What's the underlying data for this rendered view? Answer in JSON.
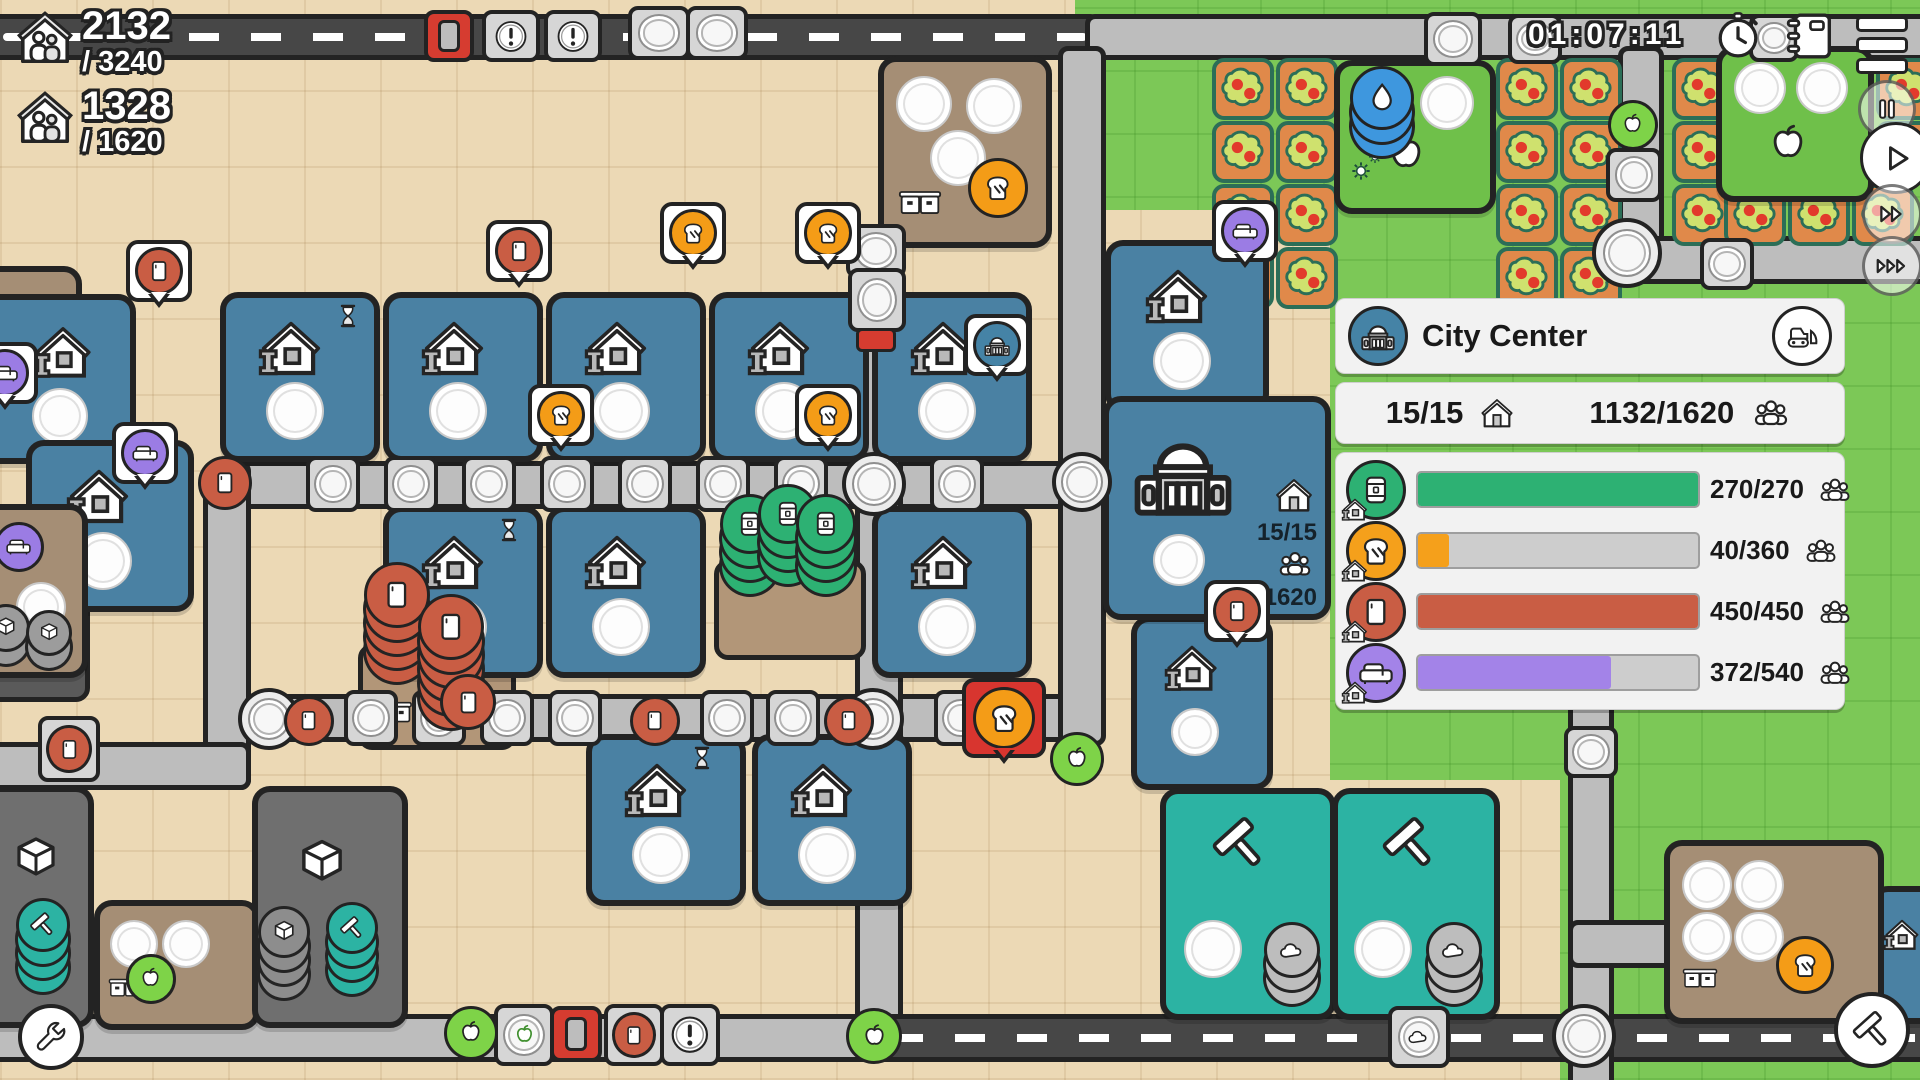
{
  "hud": {
    "population": {
      "value": "2132",
      "capacity": "/ 3240"
    },
    "housing": {
      "value": "1328",
      "capacity": "/ 1620"
    },
    "timer": "01:07:11"
  },
  "panel": {
    "title": "City Center",
    "stats": {
      "houses": "15/15",
      "population": "1132/1620"
    },
    "needs": [
      {
        "name": "drinks",
        "value": "270/270",
        "pct": 100,
        "color": "#2db173"
      },
      {
        "name": "bread",
        "value": "40/360",
        "pct": 11,
        "color": "#f5a01b"
      },
      {
        "name": "goods",
        "value": "450/450",
        "pct": 100,
        "color": "#c95d44"
      },
      {
        "name": "furniture",
        "value": "372/540",
        "pct": 69,
        "color": "#a383e8"
      }
    ]
  },
  "map": {
    "city_center": {
      "houses": "15/15",
      "population": "1132/1620"
    }
  }
}
